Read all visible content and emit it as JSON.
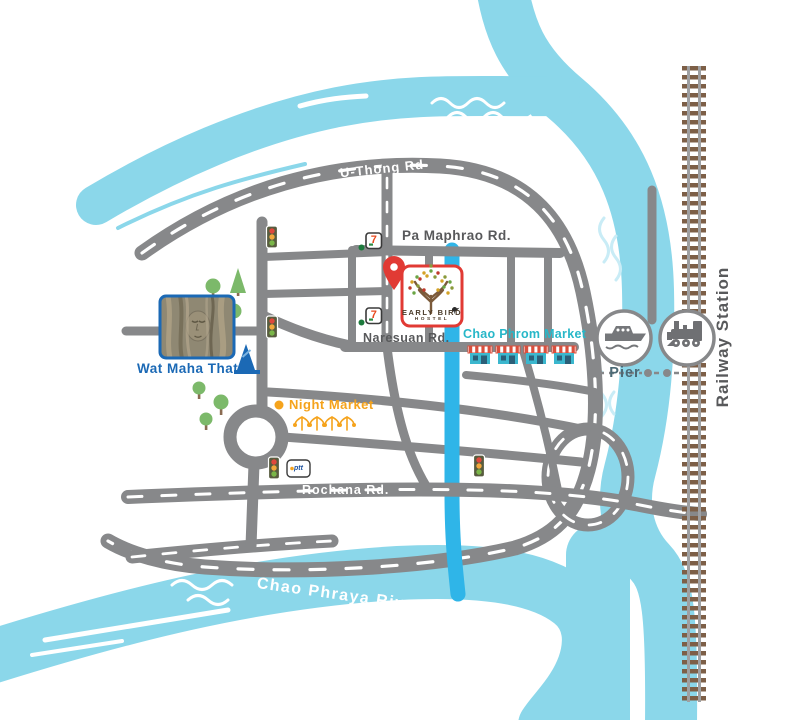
{
  "rivers": {
    "pasak": "Pasak River",
    "chao_phraya": "Chao Phraya River"
  },
  "roads": {
    "u_thong": "U-Thong Rd",
    "pa_maphrao": "Pa Maphrao Rd.",
    "naresuan": "Naresuan Rd.",
    "rochana": "Rochana Rd."
  },
  "places": {
    "hostel_name": "EARLY BIRD",
    "hostel_sub": "HOSTEL",
    "wat": "Wat Maha That",
    "market": "Chao Phrom Market",
    "night_market": "Night Market",
    "pier": "Pier",
    "railway_station": "Railway Station"
  },
  "icons": {
    "seven_eleven": "7",
    "ptt": "ptt"
  },
  "colors": {
    "river": "#8bd7ea",
    "canal": "#2fb5e8",
    "road": "#87888a",
    "hostel_red": "#e13a34",
    "wat_blue": "#1b69b5",
    "market_teal": "#27b7c8",
    "night_orange": "#f5a31c",
    "rail_brown": "#7d5f47",
    "label_dark": "#58595b",
    "pier_text": "#4c6a76"
  }
}
